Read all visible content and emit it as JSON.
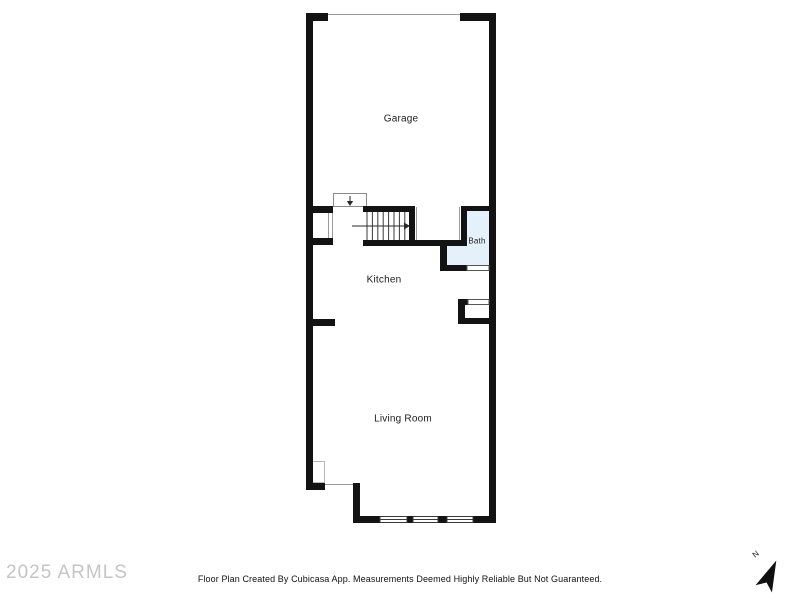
{
  "plan": {
    "rooms": {
      "garage": "Garage",
      "kitchen": "Kitchen",
      "bath": "Bath",
      "living_room": "Living Room"
    },
    "colors": {
      "wall": "#131313",
      "bath_fill": "#e5f1fa",
      "thin_line": "#8a8a8a"
    }
  },
  "compass": {
    "north_label": "N"
  },
  "watermark": {
    "text": "2025 ARMLS",
    "color": "#c5c5c5"
  },
  "footer": {
    "disclaimer": "Floor Plan Created By Cubicasa App. Measurements Deemed Highly Reliable But Not Guaranteed."
  }
}
